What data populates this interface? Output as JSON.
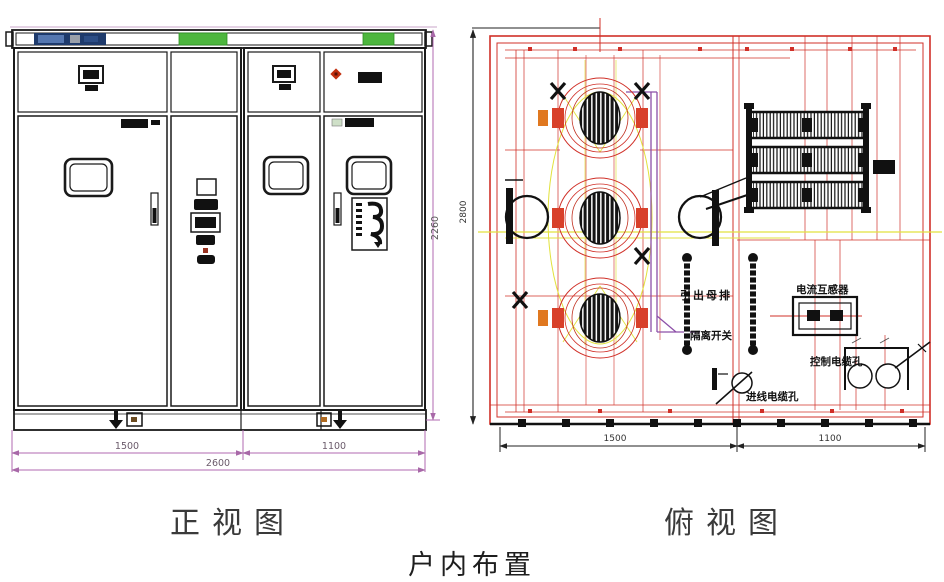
{
  "title": "户内布置",
  "front_view": {
    "caption": "正视图",
    "dim_left": "1500",
    "dim_right": "1100",
    "dim_total": "2600",
    "dim_height": "2260"
  },
  "top_view": {
    "caption": "俯视图",
    "dim_left": "1500",
    "dim_right": "1100",
    "dim_depth": "2800",
    "labels": {
      "busbar": "引出母排",
      "disconnector": "隔离开关",
      "current_transformer": "电流互感器",
      "control_cable_hole": "控制电缆孔",
      "incoming_cable_hole": "进线电缆孔"
    }
  },
  "colors": {
    "drawing_black": "#1a1a1a",
    "drawing_red": "#d03028",
    "construction_yellow": "#e2e23e",
    "routing_purple": "#8c4fa8",
    "dimension_magenta": "#b06ab0",
    "indicator_green": "#4db63e",
    "nameplate_navy": "#1e3a6b",
    "accent_orange": "#e07820"
  }
}
